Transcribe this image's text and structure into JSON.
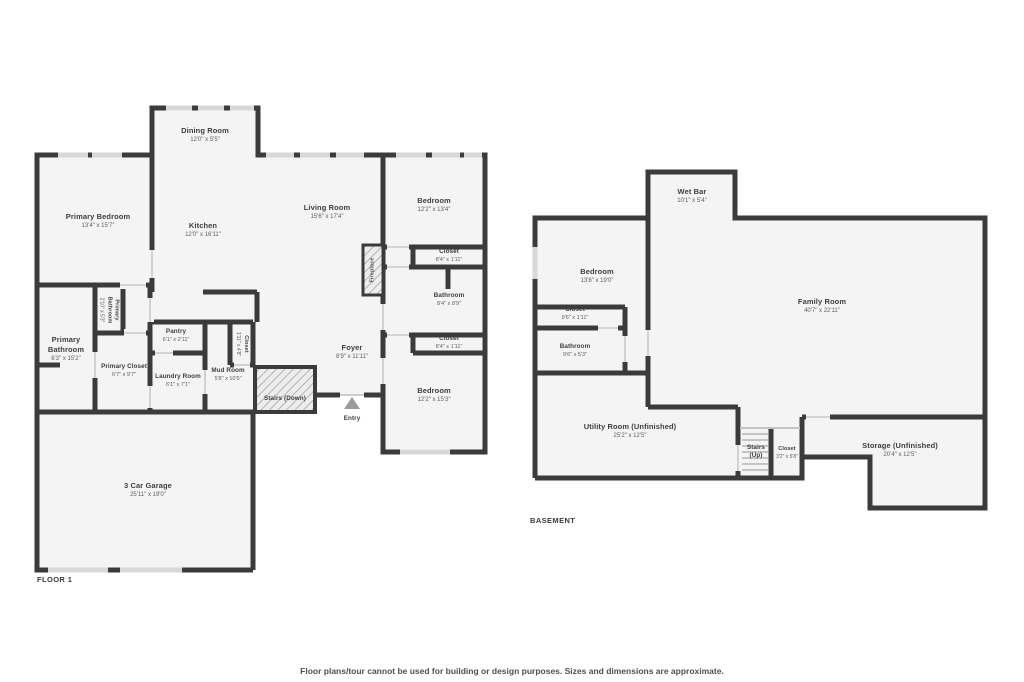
{
  "colors": {
    "background": "#ffffff",
    "wall": "#3b3b3b",
    "floor_fill": "#f4f4f4",
    "window": "#d8d8d8",
    "hatch_line": "#a3a3a3",
    "entry_marker": "#9b9b9b"
  },
  "footer": {
    "disclaimer": "Floor plans/tour cannot be used for building or design purposes. Sizes and dimensions are approximate."
  },
  "floor1": {
    "label": "FLOOR 1",
    "rooms": [
      {
        "name": "Primary Bedroom",
        "dims": "13'4\" x 15'7\""
      },
      {
        "name": "Dining Room",
        "dims": "12'0\" x 5'5\""
      },
      {
        "name": "Kitchen",
        "dims": "12'0\" x 16'11\""
      },
      {
        "name": "Living Room",
        "dims": "15'6\" x 17'4\""
      },
      {
        "name": "Bedroom",
        "dims": "12'2\" x 13'4\""
      },
      {
        "name": "Closet",
        "dims": "8'4\" x 1'11\""
      },
      {
        "name": "Bathroom",
        "dims": "8'4\" x 8'9\""
      },
      {
        "name": "Closet",
        "dims": "8'4\" x 1'11\""
      },
      {
        "name": "Bedroom",
        "dims": "12'2\" x 15'3\""
      },
      {
        "name": "Foyer",
        "dims": "8'9\" x 11'11\""
      },
      {
        "name": "Stairs (Down)"
      },
      {
        "name": "Entry"
      },
      {
        "name": "Mud Room",
        "dims": "5'8\" x 10'5\""
      },
      {
        "name": "Closet",
        "dims": "1'11\" x 4'8\""
      },
      {
        "name": "Laundry Room",
        "dims": "6'1\" x 7'1\""
      },
      {
        "name": "Pantry",
        "dims": "6'1\" x 2'11\""
      },
      {
        "name": "Primary Closet",
        "dims": "6'7\" x 9'7\""
      },
      {
        "name": "Primary Bathroom",
        "dims": "6'3\" x 15'2\""
      },
      {
        "name": "Primary Bathroom",
        "dims": "2'10\" x 5'3\""
      },
      {
        "name": "Fireplace"
      },
      {
        "name": "3 Car Garage",
        "dims": "25'11\" x 19'0\""
      }
    ]
  },
  "basement": {
    "label": "BASEMENT",
    "rooms": [
      {
        "name": "Wet Bar",
        "dims": "10'1\" x 5'4\""
      },
      {
        "name": "Bedroom",
        "dims": "13'8\" x 19'0\""
      },
      {
        "name": "Closet",
        "dims": "9'6\" x 1'11\""
      },
      {
        "name": "Bathroom",
        "dims": "9'6\" x 5'3\""
      },
      {
        "name": "Family Room",
        "dims": "40'7\" x 22'11\""
      },
      {
        "name": "Utility Room (Unfinished)",
        "dims": "25'2\" x 12'5\""
      },
      {
        "name": "Stairs (Up)"
      },
      {
        "name": "Closet",
        "dims": "3'2\" x 5'8\""
      },
      {
        "name": "Storage (Unfinished)",
        "dims": "20'4\" x 12'5\""
      }
    ]
  }
}
